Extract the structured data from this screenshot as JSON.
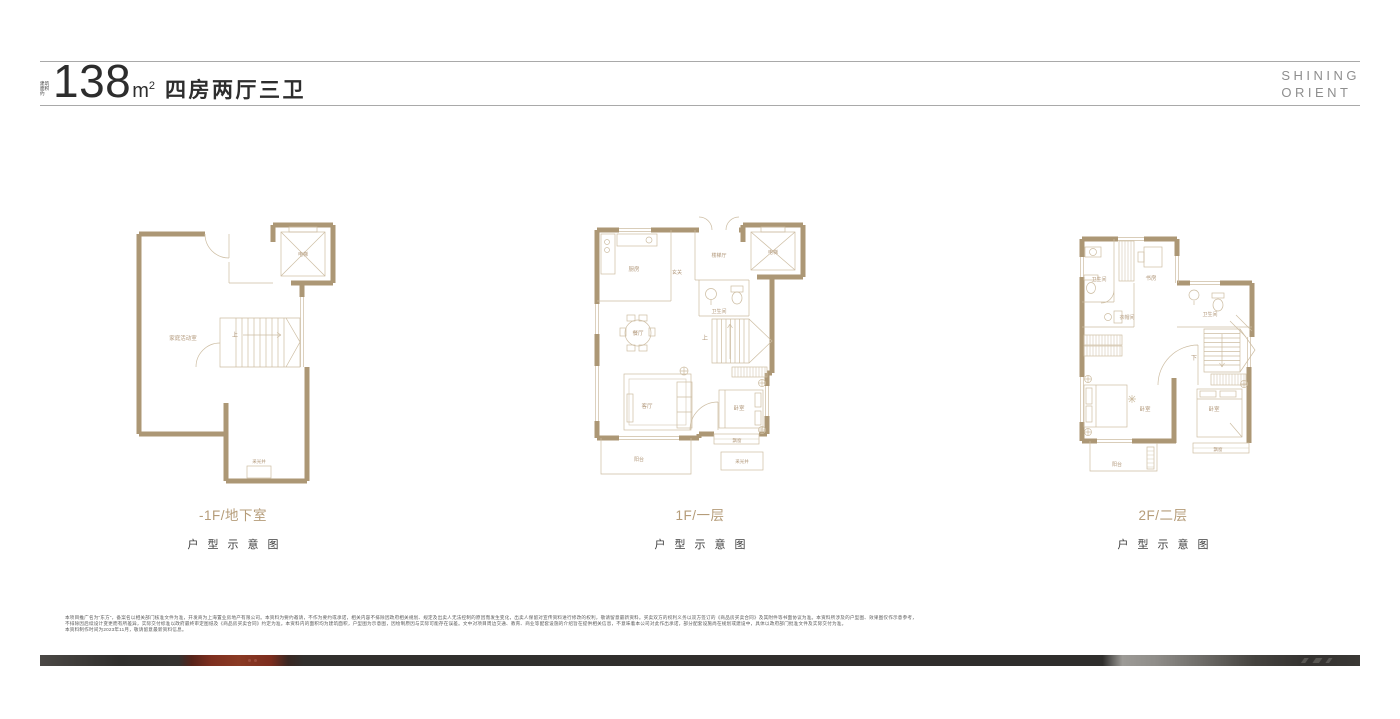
{
  "header": {
    "area_prefix": "建筑面积约",
    "area_value": "138",
    "area_unit_base": "m",
    "area_unit_sup": "2",
    "layout_text": "四房两厅三卫",
    "brand_line1": "SHINING",
    "brand_line2": "ORIENT"
  },
  "plans": [
    {
      "floor_label": "-1F/地下室",
      "caption": "户型示意图",
      "rooms": {
        "main": "家庭活动室",
        "elevator": "电梯",
        "up": "上",
        "lightwell": "采光井"
      }
    },
    {
      "floor_label": "1F/一层",
      "caption": "户型示意图",
      "rooms": {
        "kitchen": "厨房",
        "entry": "玄关",
        "stair_hall": "楼梯厅",
        "elevator": "电梯",
        "bath": "卫生间",
        "up": "上",
        "dining": "餐厅",
        "living": "客厅",
        "bedroom": "卧室",
        "bay_window": "飘窗",
        "lightwell": "采光井",
        "balcony": "阳台"
      }
    },
    {
      "floor_label": "2F/二层",
      "caption": "户型示意图",
      "rooms": {
        "bath_a": "卫生间",
        "study": "书房",
        "bath_b": "卫生间",
        "closet": "衣帽间",
        "down": "下",
        "bedroom_a": "卧室",
        "bedroom_b": "卧室",
        "balcony": "阳台",
        "bay_window": "飘窗"
      }
    }
  ],
  "disclaimer": {
    "line1": "本项目推广名为“东方”，备案名以相关部门核准文件为准，开发商为上海置业房地产有限公司。本资料为要约邀请，不作为要约或承诺，相关内容不排除因政府相关规划、规定及出卖人无法控制的原因而发生变化，出卖人保留对宣传资料进行修改的权利，敬请留意最新资料。买卖双方的权利义务以双方签订的《商品房买卖合同》及其附件等书面协议为准。本资料所涉及的户型图、效果图仅作示意参考，",
    "line2": "不排除因后续设计变更而有所差异，实际交付标准以政府最终审定图纸及《商品房买卖合同》约定为准。本资料内的面积均为建筑面积，户型图为示意图，因绘制原因与实际可能存在误差。文中对项目周边交通、教育、商业等配套设施的介绍旨在提供相关信息，不意味着本公司对此作出承诺，部分配套设施尚在规划或建设中，具体以政府部门批准文件及实际交付为准。",
    "line3": "本资料制作时间为2023年11月，敬请留意最新资料信息。"
  },
  "colors": {
    "wall_tan": "#ac9775",
    "label_tan": "#b2987a",
    "caption_dark": "#3d3d3d",
    "bar_red": "#7e2f1f",
    "bar_dark": "#302f2d",
    "rule_gray": "#a9a9a9"
  }
}
